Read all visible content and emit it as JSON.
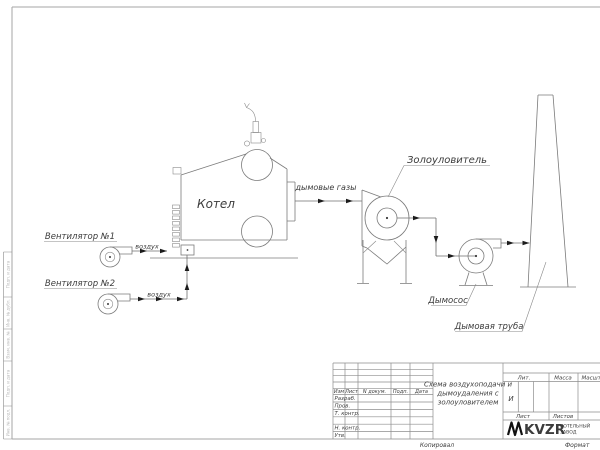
{
  "diagram": {
    "boiler_label": "Котел",
    "fan1_label": "Вентилятор №1",
    "fan2_label": "Вентилятор №2",
    "air1_label": "воздух",
    "air2_label": "воздух",
    "flue_label": "дымовые газы",
    "ash_collector_label": "Золоуловитель",
    "exhauster_label": "Дымосос",
    "chimney_label": "Дымовая труба"
  },
  "titleblock": {
    "header_cols": [
      "Изм",
      "Лист",
      "N докум.",
      "Подп.",
      "Дата"
    ],
    "sign_rows": [
      "Разраб.",
      "Пров.",
      "Т. контр.",
      "Н. контр.",
      "Утв."
    ],
    "title_lines": [
      "Схема воздухоподачи и",
      "дымоудаления с",
      "золоуловителем"
    ],
    "lit_header": "Лит.",
    "mass_header": "Масса",
    "scale_header": "Масштаб",
    "lit_value": "И",
    "sheet_label": "Лист",
    "sheets_label": "Листов",
    "logo_text": "KVZR",
    "org_line1": "КОТЕЛЬНЫЙ",
    "org_line2": "ЗАВОД"
  },
  "frame": {
    "kopiroval": "Копировал",
    "format": "Формат"
  },
  "side_strip": {
    "labels": [
      "Подп. и дата",
      "Инв. № дубл.",
      "Взам. инв. №",
      "Подп. и дата",
      "Инв. № подл."
    ]
  },
  "colors": {
    "line": "#7b7b7b",
    "text": "#3c3c3c",
    "arrow": "#1c1c1c",
    "frame": "#a5a5a5"
  }
}
